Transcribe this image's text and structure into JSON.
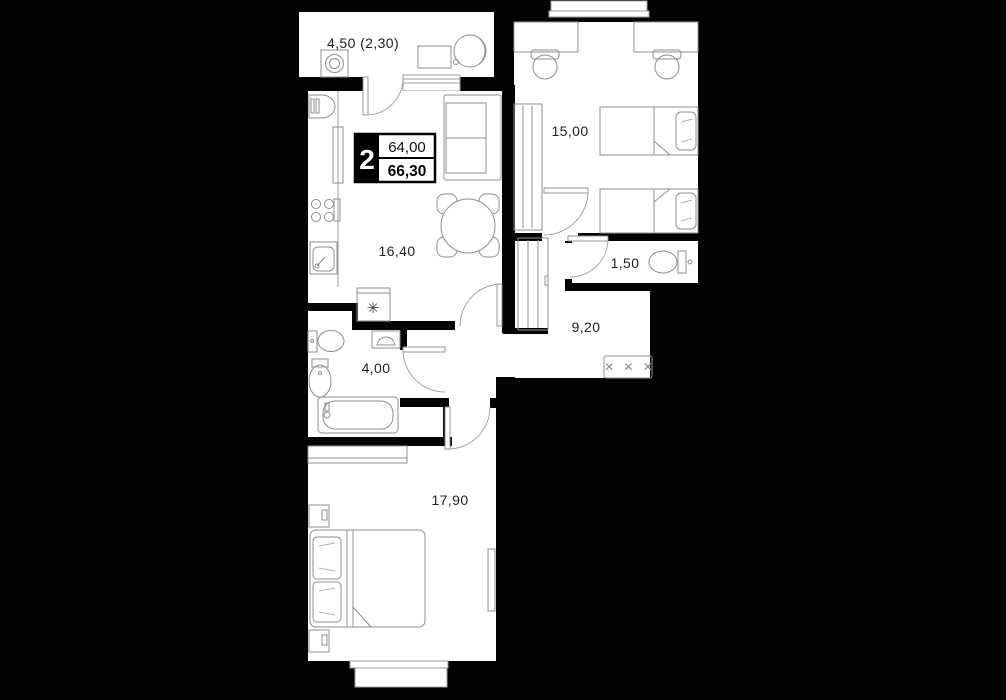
{
  "plan": {
    "title_badge": {
      "rooms_count": "2",
      "total_area": "64,00",
      "living_area": "66,30"
    },
    "rooms": {
      "balcony": {
        "area_label": "4,50 (2,30)"
      },
      "kitchen_living": {
        "area_label": "16,40"
      },
      "bedroom_top": {
        "area_label": "15,00"
      },
      "wc": {
        "area_label": "1,50"
      },
      "hallway": {
        "area_label": "9,20"
      },
      "bathroom": {
        "area_label": "4,00"
      },
      "bedroom_bottom": {
        "area_label": "17,90"
      }
    },
    "symbols": {
      "fridge_snowflake": "✳",
      "hanger_crosses": "✕ ✕ ✕"
    },
    "colors": {
      "wall": "#000000",
      "floor": "#ffffff",
      "furniture_line": "#8f8f8f",
      "label_text": "#1f1f1f"
    }
  }
}
